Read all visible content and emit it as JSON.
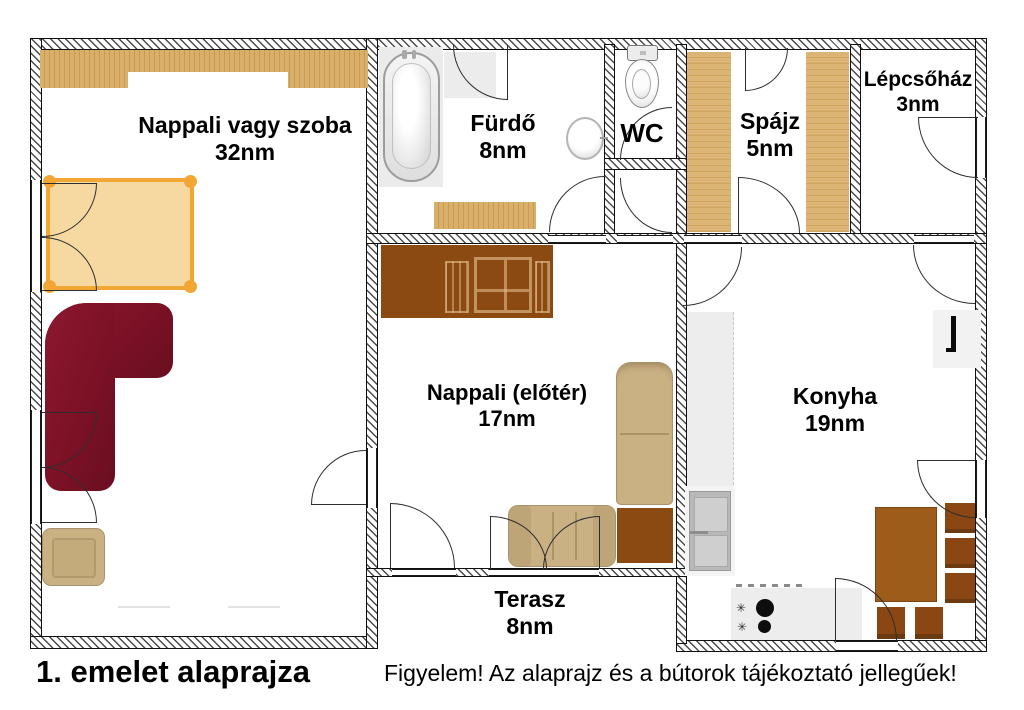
{
  "title": "1. emelet alaprajza",
  "disclaimer": "Figyelem! Az alaprajz és a bútorok tájékoztató jellegűek!",
  "rooms": [
    {
      "name": "Nappali vagy szoba",
      "area": "32nm"
    },
    {
      "name": "Fürdő",
      "area": "8nm"
    },
    {
      "name": "WC"
    },
    {
      "name": "Spájz",
      "area": "5nm"
    },
    {
      "name": "Lépcsőház",
      "area": "3nm"
    },
    {
      "name": "Nappali (előtér)",
      "area": "17nm"
    },
    {
      "name": "Konyha",
      "area": "19nm"
    },
    {
      "name": "Terasz",
      "area": "8nm"
    }
  ],
  "icons": {
    "burner_symbol": "✳"
  },
  "colors": {
    "wall_hatch": "#4a4a4a",
    "wood_light": "#d9b06a",
    "wood_dark": "#c89a55",
    "cabinet_brown": "#8a4a11",
    "table_brown": "#9d5c1a",
    "chair_brown": "#8a4713",
    "sofa_maroon": "#7c1126",
    "sofa_tan": "#c9b184",
    "bed_fill": "#f5d9a1",
    "bed_frame": "#f2a735",
    "counter_gray": "#ededed",
    "fridge_gray": "#b8b8b8"
  }
}
